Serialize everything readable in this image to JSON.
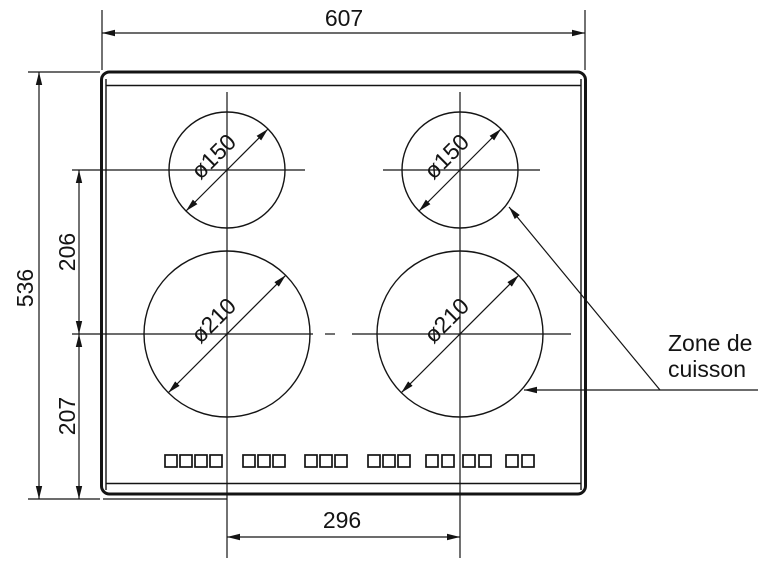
{
  "figure": {
    "background": "#ffffff",
    "line_color": "#141414"
  },
  "dimensions": {
    "overall_width": "607",
    "overall_height": "536",
    "upper_zone_spacing": "206",
    "lower_zone_offset": "207",
    "zone_horizontal_spacing": "296"
  },
  "zones": {
    "small_zone_diameter": "ø150",
    "large_zone_diameter": "ø210"
  },
  "label": {
    "line1": "Zone de",
    "line2": "cuisson"
  },
  "touch_controls": {
    "groups": [
      4,
      3,
      3,
      3,
      4,
      2
    ]
  }
}
